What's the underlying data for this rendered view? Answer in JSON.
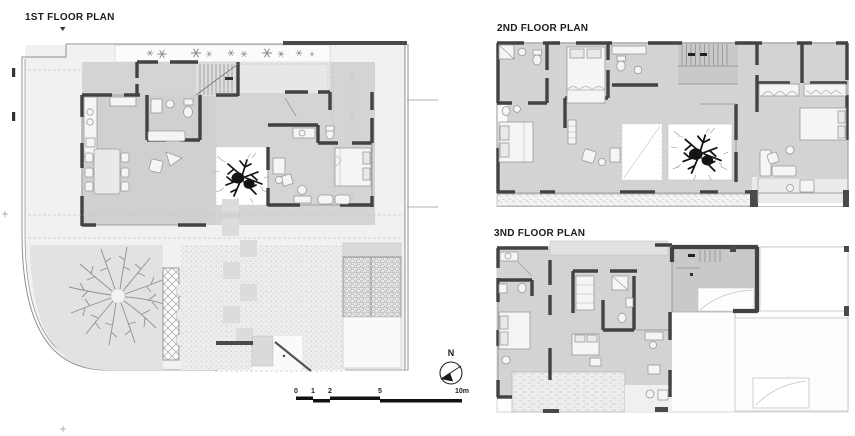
{
  "header": {
    "first_title": "1ST FLOOR PLAN",
    "second_title": "2ND FLOOR PLAN",
    "third_title": "3ND FLOOR PLAN"
  },
  "compass": {
    "north_label": "N"
  },
  "scale_bar": {
    "ticks": [
      "0",
      "1",
      "2",
      "5",
      "10m"
    ]
  },
  "palette": {
    "wall": "#424242",
    "room_floor": "#d3d3d3",
    "stair_floor": "#c9c9c9",
    "garden": "#e2e2e2",
    "paving": "#ececec",
    "void_white": "#ffffff",
    "text": "#1c1c1c"
  }
}
